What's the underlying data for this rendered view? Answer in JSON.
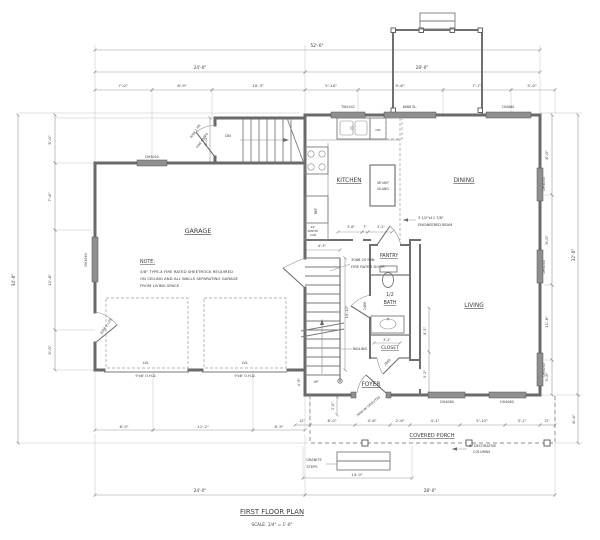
{
  "drawing": {
    "title": "FIRST FLOOR PLAN",
    "scale": "SCALE: 1/4\" = 1'-0\"",
    "line_color": "#6a6a6a",
    "dim_color": "#999999",
    "bg_color": "#ffffff"
  },
  "rooms": [
    "GARAGE",
    "KITCHEN",
    "DINING",
    "LIVING",
    "PANTRY",
    "1/2 BATH",
    "CLOSET",
    "FOYER",
    "COVERED PORCH"
  ],
  "note": {
    "heading": "NOTE:",
    "lines": [
      "5/8\" TYPE-X FIRE RATED SHEETROCK REQUIRED",
      "ON CEILING AND ALL WALLS SEPARATING GARAGE",
      "FROM LIVING SPACE"
    ]
  },
  "overall_dimensions": {
    "width": "52'-0\"",
    "left_depth": "34'-0\"",
    "right_depth": "32'-0\"",
    "garage_width": "24'-0\"",
    "house_width": "28'-0\""
  },
  "labels": [
    {
      "t": "52'-0\"",
      "x": 317,
      "y": 47,
      "s": 4.4,
      "n": "dim-overall-width"
    },
    {
      "t": "24'-0\"",
      "x": 200,
      "y": 69,
      "s": 4.2,
      "n": "dim-garage-width"
    },
    {
      "t": "28'-0\"",
      "x": 422,
      "y": 69,
      "s": 4.2,
      "n": "dim-house-width"
    },
    {
      "t": "7'-0\"",
      "x": 123,
      "y": 87,
      "s": 3.9,
      "n": "dim-label"
    },
    {
      "t": "6'-9\"",
      "x": 182,
      "y": 87,
      "s": 3.9,
      "n": "dim-label"
    },
    {
      "t": "10'-3\"",
      "x": 258,
      "y": 87,
      "s": 3.9,
      "n": "dim-label"
    },
    {
      "t": "5'-10\"",
      "x": 331,
      "y": 87,
      "s": 3.9,
      "n": "dim-label"
    },
    {
      "t": "9'-6\"",
      "x": 400,
      "y": 87,
      "s": 3.9,
      "n": "dim-label"
    },
    {
      "t": "7'-7\"",
      "x": 477,
      "y": 87,
      "s": 3.9,
      "n": "dim-label"
    },
    {
      "t": "5'-0\"",
      "x": 532,
      "y": 87,
      "s": 3.9,
      "n": "dim-label"
    },
    {
      "t": "5'-0\"",
      "x": 207,
      "y": 141,
      "s": 3.9,
      "r": -90,
      "n": "dim-label"
    },
    {
      "t": "34'-0\"",
      "x": 15,
      "y": 280,
      "s": 4.2,
      "r": -90,
      "n": "dim-overall-left"
    },
    {
      "t": "5'-0\"",
      "x": 51,
      "y": 140,
      "s": 3.9,
      "r": -90,
      "n": "dim-label"
    },
    {
      "t": "7'-6\"",
      "x": 51,
      "y": 197,
      "s": 3.9,
      "r": -90,
      "n": "dim-label"
    },
    {
      "t": "11'-6\"",
      "x": 51,
      "y": 280,
      "s": 3.9,
      "r": -90,
      "n": "dim-label"
    },
    {
      "t": "5'-0\"",
      "x": 51,
      "y": 350,
      "s": 3.9,
      "r": -90,
      "n": "dim-label"
    },
    {
      "t": "8'-0\"",
      "x": 548,
      "y": 155,
      "s": 3.9,
      "r": -90,
      "n": "dim-label"
    },
    {
      "t": "9'-0\"",
      "x": 548,
      "y": 240,
      "s": 3.9,
      "r": -90,
      "n": "dim-label"
    },
    {
      "t": "11'-6\"",
      "x": 548,
      "y": 322,
      "s": 3.9,
      "r": -90,
      "n": "dim-label"
    },
    {
      "t": "3'-6\"",
      "x": 548,
      "y": 377,
      "s": 3.9,
      "r": -90,
      "n": "dim-label"
    },
    {
      "t": "32'-0\"",
      "x": 575,
      "y": 255,
      "s": 4.2,
      "r": -90,
      "n": "dim-overall-right"
    },
    {
      "t": "6'-4\"",
      "x": 575,
      "y": 419,
      "s": 3.9,
      "r": -90,
      "n": "dim-label"
    },
    {
      "t": "DH3040",
      "x": 152,
      "y": 158,
      "s": 3.3,
      "n": "window-label"
    },
    {
      "t": "DH3040",
      "x": 87,
      "y": 260,
      "s": 3.3,
      "r": -90,
      "n": "window-label"
    },
    {
      "t": "TW2442",
      "x": 348,
      "y": 108,
      "s": 3.3,
      "n": "window-label"
    },
    {
      "t": "6068 SL.",
      "x": 410,
      "y": 108,
      "s": 3.3,
      "n": "door-label"
    },
    {
      "t": "2X4060",
      "x": 508,
      "y": 108,
      "s": 3.3,
      "n": "window-label"
    },
    {
      "t": "DH3050",
      "x": 545,
      "y": 184,
      "s": 3.3,
      "r": -90,
      "n": "window-label"
    },
    {
      "t": "DH3050",
      "x": 545,
      "y": 267,
      "s": 3.3,
      "r": -90,
      "n": "window-label"
    },
    {
      "t": "DH3050",
      "x": 545,
      "y": 370,
      "s": 3.3,
      "r": -90,
      "n": "window-label"
    },
    {
      "t": "DH4060",
      "x": 447,
      "y": 403,
      "s": 3.3,
      "n": "window-label"
    },
    {
      "t": "DH4060",
      "x": 507,
      "y": 403,
      "s": 3.3,
      "n": "window-label"
    },
    {
      "t": "GARAGE",
      "x": 198,
      "y": 233,
      "s": 6.4,
      "u": true,
      "n": "room-label-garage"
    },
    {
      "t": "KITCHEN",
      "x": 349,
      "y": 182,
      "s": 5.8,
      "u": true,
      "n": "room-label-kitchen"
    },
    {
      "t": "DINING",
      "x": 464,
      "y": 182,
      "s": 5.8,
      "u": true,
      "n": "room-label-dining"
    },
    {
      "t": "LIVING",
      "x": 474,
      "y": 307,
      "s": 5.8,
      "u": true,
      "n": "room-label-living"
    },
    {
      "t": "PANTRY",
      "x": 389,
      "y": 257,
      "s": 4.8,
      "u": true,
      "n": "room-label-pantry"
    },
    {
      "t": "1/2",
      "x": 390,
      "y": 296,
      "s": 4.8,
      "n": "room-label-half-bath"
    },
    {
      "t": "BATH",
      "x": 390,
      "y": 304,
      "s": 4.8,
      "u": true,
      "n": "room-label-half-bath"
    },
    {
      "t": "CLOSET",
      "x": 390,
      "y": 349,
      "s": 4.6,
      "u": true,
      "n": "room-label-closet"
    },
    {
      "t": "FOYER",
      "x": 371,
      "y": 386,
      "s": 5.8,
      "u": true,
      "n": "room-label-foyer"
    },
    {
      "t": "COVERED PORCH",
      "x": 432,
      "y": 437,
      "s": 5.2,
      "u": true,
      "n": "room-label-covered-porch"
    },
    {
      "t": "NOTE:",
      "x": 140,
      "y": 263,
      "s": 4.8,
      "a": "start",
      "u": true,
      "n": "note-heading"
    },
    {
      "t": "5/8\" TYPE-X FIRE RATED SHEETROCK REQUIRED",
      "x": 140,
      "y": 273,
      "s": 3.9,
      "a": "start",
      "n": "note-line"
    },
    {
      "t": "ON CEILING AND ALL WALLS SEPARATING GARAGE",
      "x": 140,
      "y": 280,
      "s": 3.9,
      "a": "start",
      "n": "note-line"
    },
    {
      "t": "FROM LIVING SPACE",
      "x": 140,
      "y": 287,
      "s": 3.9,
      "a": "start",
      "n": "note-line"
    },
    {
      "t": "LVL",
      "x": 146,
      "y": 364,
      "s": 3.6,
      "n": "beam-label"
    },
    {
      "t": "LVL",
      "x": 245,
      "y": 364,
      "s": 3.6,
      "n": "beam-label"
    },
    {
      "t": "9'x8' O.H.D.",
      "x": 146,
      "y": 377,
      "s": 3.6,
      "n": "garage-door-label"
    },
    {
      "t": "9'x8' O.H.D.",
      "x": 245,
      "y": 377,
      "s": 3.6,
      "n": "garage-door-label"
    },
    {
      "t": "3068 9 LITE",
      "x": 107,
      "y": 327,
      "s": 3.2,
      "r": -55,
      "n": "door-label"
    },
    {
      "t": "DN",
      "x": 228,
      "y": 137,
      "s": 3.7,
      "n": "stair-direction-label"
    },
    {
      "t": "3068 1 HR",
      "x": 196,
      "y": 132,
      "s": 3.1,
      "r": -55,
      "n": "door-label"
    },
    {
      "t": "FIRE RATED",
      "x": 203,
      "y": 141,
      "s": 3.1,
      "r": -55,
      "n": "door-label"
    },
    {
      "t": "3068 20 MIN",
      "x": 351,
      "y": 261,
      "s": 3.7,
      "a": "start",
      "n": "door-note"
    },
    {
      "t": "FIRE RATED DOOR",
      "x": 351,
      "y": 268,
      "s": 3.7,
      "a": "start",
      "n": "door-note"
    },
    {
      "t": "UP",
      "x": 316,
      "y": 383,
      "s": 3.7,
      "n": "stair-direction-label"
    },
    {
      "t": "RAILING",
      "x": 360,
      "y": 350,
      "s": 3.7,
      "n": "railing-label"
    },
    {
      "t": "2468",
      "x": 366,
      "y": 306,
      "s": 3.1,
      "r": -90,
      "n": "door-label"
    },
    {
      "t": "2868",
      "x": 388,
      "y": 363,
      "s": 3.1,
      "r": -45,
      "n": "door-label"
    },
    {
      "t": "3068 W/ SIDELITES",
      "x": 369,
      "y": 407,
      "s": 3.1,
      "r": -40,
      "n": "door-label"
    },
    {
      "t": "36\"x60\"",
      "x": 383,
      "y": 184,
      "s": 3.1,
      "n": "island-label"
    },
    {
      "t": "ISLAND",
      "x": 383,
      "y": 190,
      "s": 3.1,
      "n": "island-label"
    },
    {
      "t": "DW",
      "x": 378,
      "y": 131,
      "s": 2.9,
      "n": "dishwasher-label"
    },
    {
      "t": "REF",
      "x": 317,
      "y": 211,
      "s": 3.2,
      "r": -90,
      "n": "refrigerator-label"
    },
    {
      "t": "24\"",
      "x": 313,
      "y": 228,
      "s": 2.8,
      "n": "cabinet-label"
    },
    {
      "t": "PANTRY",
      "x": 313,
      "y": 232,
      "s": 2.8,
      "n": "cabinet-label"
    },
    {
      "t": "CAB",
      "x": 313,
      "y": 236,
      "s": 2.8,
      "n": "cabinet-label"
    },
    {
      "t": "3'-6\"",
      "x": 351,
      "y": 228,
      "s": 3.3,
      "n": "dim-label"
    },
    {
      "t": "7\"",
      "x": 365,
      "y": 228,
      "s": 3.3,
      "n": "dim-label"
    },
    {
      "t": "3'-2\"",
      "x": 381,
      "y": 228,
      "s": 3.3,
      "n": "dim-label"
    },
    {
      "t": "3 1/2\"x11 7/8\"",
      "x": 418,
      "y": 219,
      "s": 3.5,
      "a": "start",
      "n": "beam-note"
    },
    {
      "t": "ENGINEERED BEAM",
      "x": 418,
      "y": 226,
      "s": 3.5,
      "a": "start",
      "n": "beam-note"
    },
    {
      "t": "4'-3\"",
      "x": 322,
      "y": 247,
      "s": 3.5,
      "n": "dim-label"
    },
    {
      "t": "10'-10\"",
      "x": 348,
      "y": 312,
      "s": 3.5,
      "r": -90,
      "n": "dim-label"
    },
    {
      "t": "4'-9\"",
      "x": 300,
      "y": 382,
      "s": 3.5,
      "r": -90,
      "n": "dim-label"
    },
    {
      "t": "3'-2\"",
      "x": 387,
      "y": 341,
      "s": 3.3,
      "n": "dim-label"
    },
    {
      "t": "4'-3\"",
      "x": 426,
      "y": 331,
      "s": 3.3,
      "r": -90,
      "n": "dim-label"
    },
    {
      "t": "5'-2\"",
      "x": 426,
      "y": 374,
      "s": 3.3,
      "r": -90,
      "n": "dim-label"
    },
    {
      "t": "2'-0\"",
      "x": 334,
      "y": 406,
      "s": 3.3,
      "r": -90,
      "n": "dim-label"
    },
    {
      "t": "6'-5\"",
      "x": 124,
      "y": 428,
      "s": 3.8,
      "n": "dim-label"
    },
    {
      "t": "11'-2\"",
      "x": 203,
      "y": 428,
      "s": 3.8,
      "n": "dim-label"
    },
    {
      "t": "6'-5\"",
      "x": 279,
      "y": 428,
      "s": 3.8,
      "n": "dim-label"
    },
    {
      "t": "12\"",
      "x": 302,
      "y": 422,
      "s": 3.1,
      "n": "dim-label"
    },
    {
      "t": "6'-0\"",
      "x": 332,
      "y": 422,
      "s": 3.8,
      "n": "dim-label"
    },
    {
      "t": "4'-6\"",
      "x": 372,
      "y": 422,
      "s": 3.8,
      "n": "dim-label"
    },
    {
      "t": "2'-6\"",
      "x": 400,
      "y": 422,
      "s": 3.8,
      "n": "dim-label"
    },
    {
      "t": "4'-1\"",
      "x": 435,
      "y": 422,
      "s": 3.8,
      "n": "dim-label"
    },
    {
      "t": "5'-10\"",
      "x": 482,
      "y": 422,
      "s": 3.8,
      "n": "dim-label"
    },
    {
      "t": "3'-1\"",
      "x": 522,
      "y": 422,
      "s": 3.8,
      "n": "dim-label"
    },
    {
      "t": "12\"",
      "x": 547,
      "y": 422,
      "s": 3.1,
      "n": "dim-label"
    },
    {
      "t": "24'-0\"",
      "x": 200,
      "y": 492,
      "s": 4.2,
      "n": "dim-label"
    },
    {
      "t": "28'-0\"",
      "x": 430,
      "y": 492,
      "s": 4.2,
      "n": "dim-label"
    },
    {
      "t": "14'-0\"",
      "x": 357,
      "y": 476,
      "s": 3.8,
      "n": "dim-label"
    },
    {
      "t": "GRANITE",
      "x": 314,
      "y": 461,
      "s": 3.5,
      "n": "steps-label"
    },
    {
      "t": "STEPS",
      "x": 312,
      "y": 468,
      "s": 3.5,
      "n": "steps-label"
    },
    {
      "t": "6\" DECORATIVE",
      "x": 469,
      "y": 447,
      "s": 3.5,
      "a": "start",
      "n": "columns-note"
    },
    {
      "t": "COLUMNS",
      "x": 473,
      "y": 453,
      "s": 3.5,
      "a": "start",
      "n": "columns-note"
    },
    {
      "t": "FIRST FLOOR PLAN",
      "x": 272,
      "y": 514,
      "s": 6.8,
      "u": true,
      "n": "plan-title"
    },
    {
      "t": "SCALE: 1/4\" = 1'-0\"",
      "x": 272,
      "y": 526,
      "s": 4.2,
      "n": "plan-scale"
    }
  ]
}
